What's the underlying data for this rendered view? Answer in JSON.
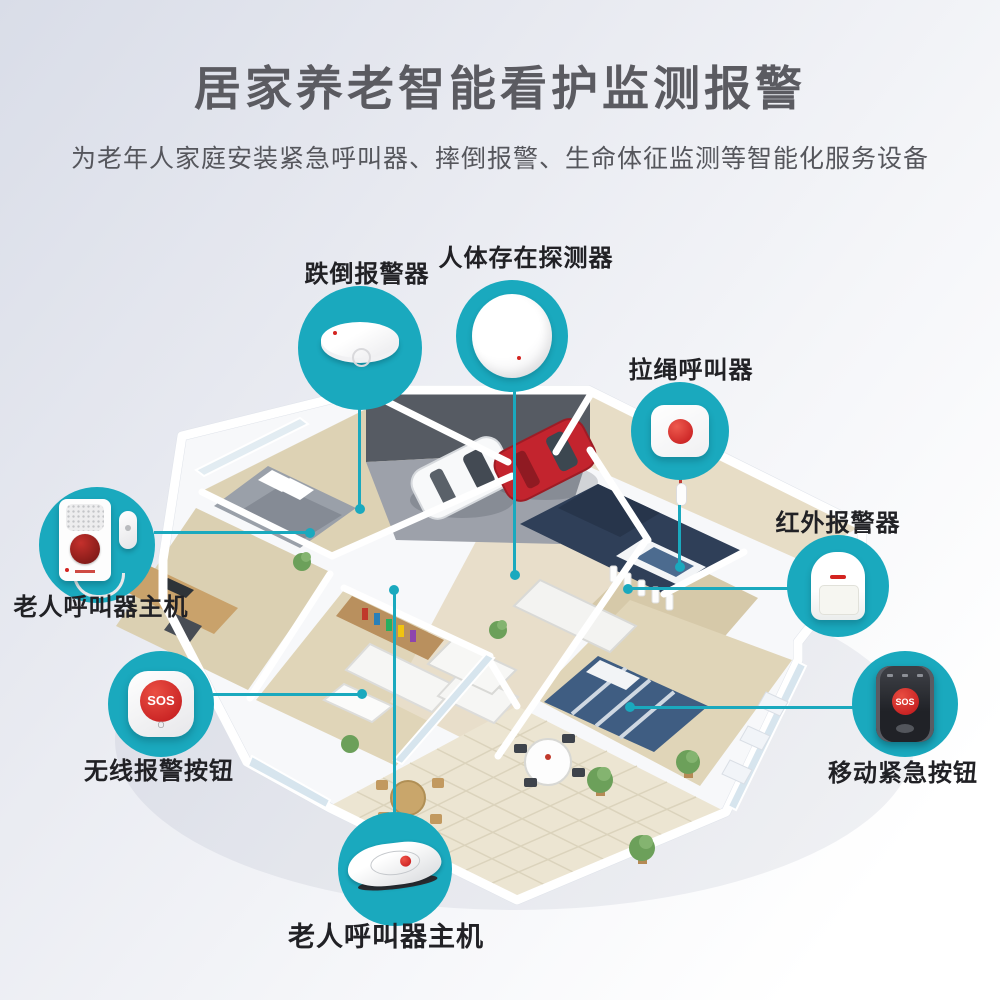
{
  "header": {
    "title": "居家养老智能看护监测报警",
    "subtitle": "为老年人家庭安装紧急呼叫器、摔倒报警、生命体征监测等智能化服务设备"
  },
  "devices": [
    {
      "id": "fall-alarm",
      "label": "跌倒报警器"
    },
    {
      "id": "presence-detector",
      "label": "人体存在探测器"
    },
    {
      "id": "pull-cord-caller",
      "label": "拉绳呼叫器"
    },
    {
      "id": "infrared-alarm",
      "label": "红外报警器"
    },
    {
      "id": "caller-host-left",
      "label": "老人呼叫器主机"
    },
    {
      "id": "wireless-alarm-button",
      "label": "无线报警按钮"
    },
    {
      "id": "mobile-emergency-button",
      "label": "移动紧急按钮"
    },
    {
      "id": "caller-host-bottom",
      "label": "老人呼叫器主机"
    }
  ],
  "sos_text": "SOS",
  "colors": {
    "accent_teal": "#1aa9be",
    "alert_red": "#d32420",
    "title_gray": "#5b5b61",
    "label_dark": "#212125"
  }
}
